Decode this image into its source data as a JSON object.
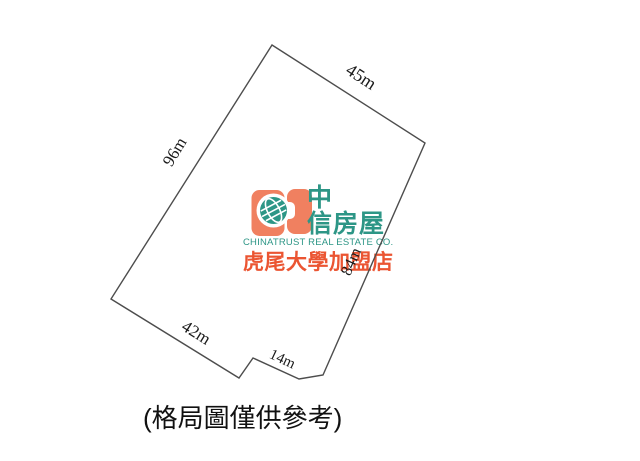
{
  "plot": {
    "dimensions": [
      {
        "side": "top-right",
        "text": "45m"
      },
      {
        "side": "left",
        "text": "96m"
      },
      {
        "side": "bottom-left",
        "text": "42m"
      },
      {
        "side": "bottom-middle",
        "text": "14m"
      },
      {
        "side": "right",
        "text": "84m"
      }
    ],
    "caption": "(格局圖僅供參考)"
  },
  "logo": {
    "brand_cjk_line1": "中",
    "brand_cjk_line2": "信房屋",
    "company_en": "CHINATRUST REAL ESTATE CO.",
    "branch": "虎尾大學加盟店",
    "colors": {
      "orange": "#F08060",
      "teal": "#2D9686",
      "branch_red": "#EB5532",
      "outline_gray": "#4D4D4D"
    }
  }
}
